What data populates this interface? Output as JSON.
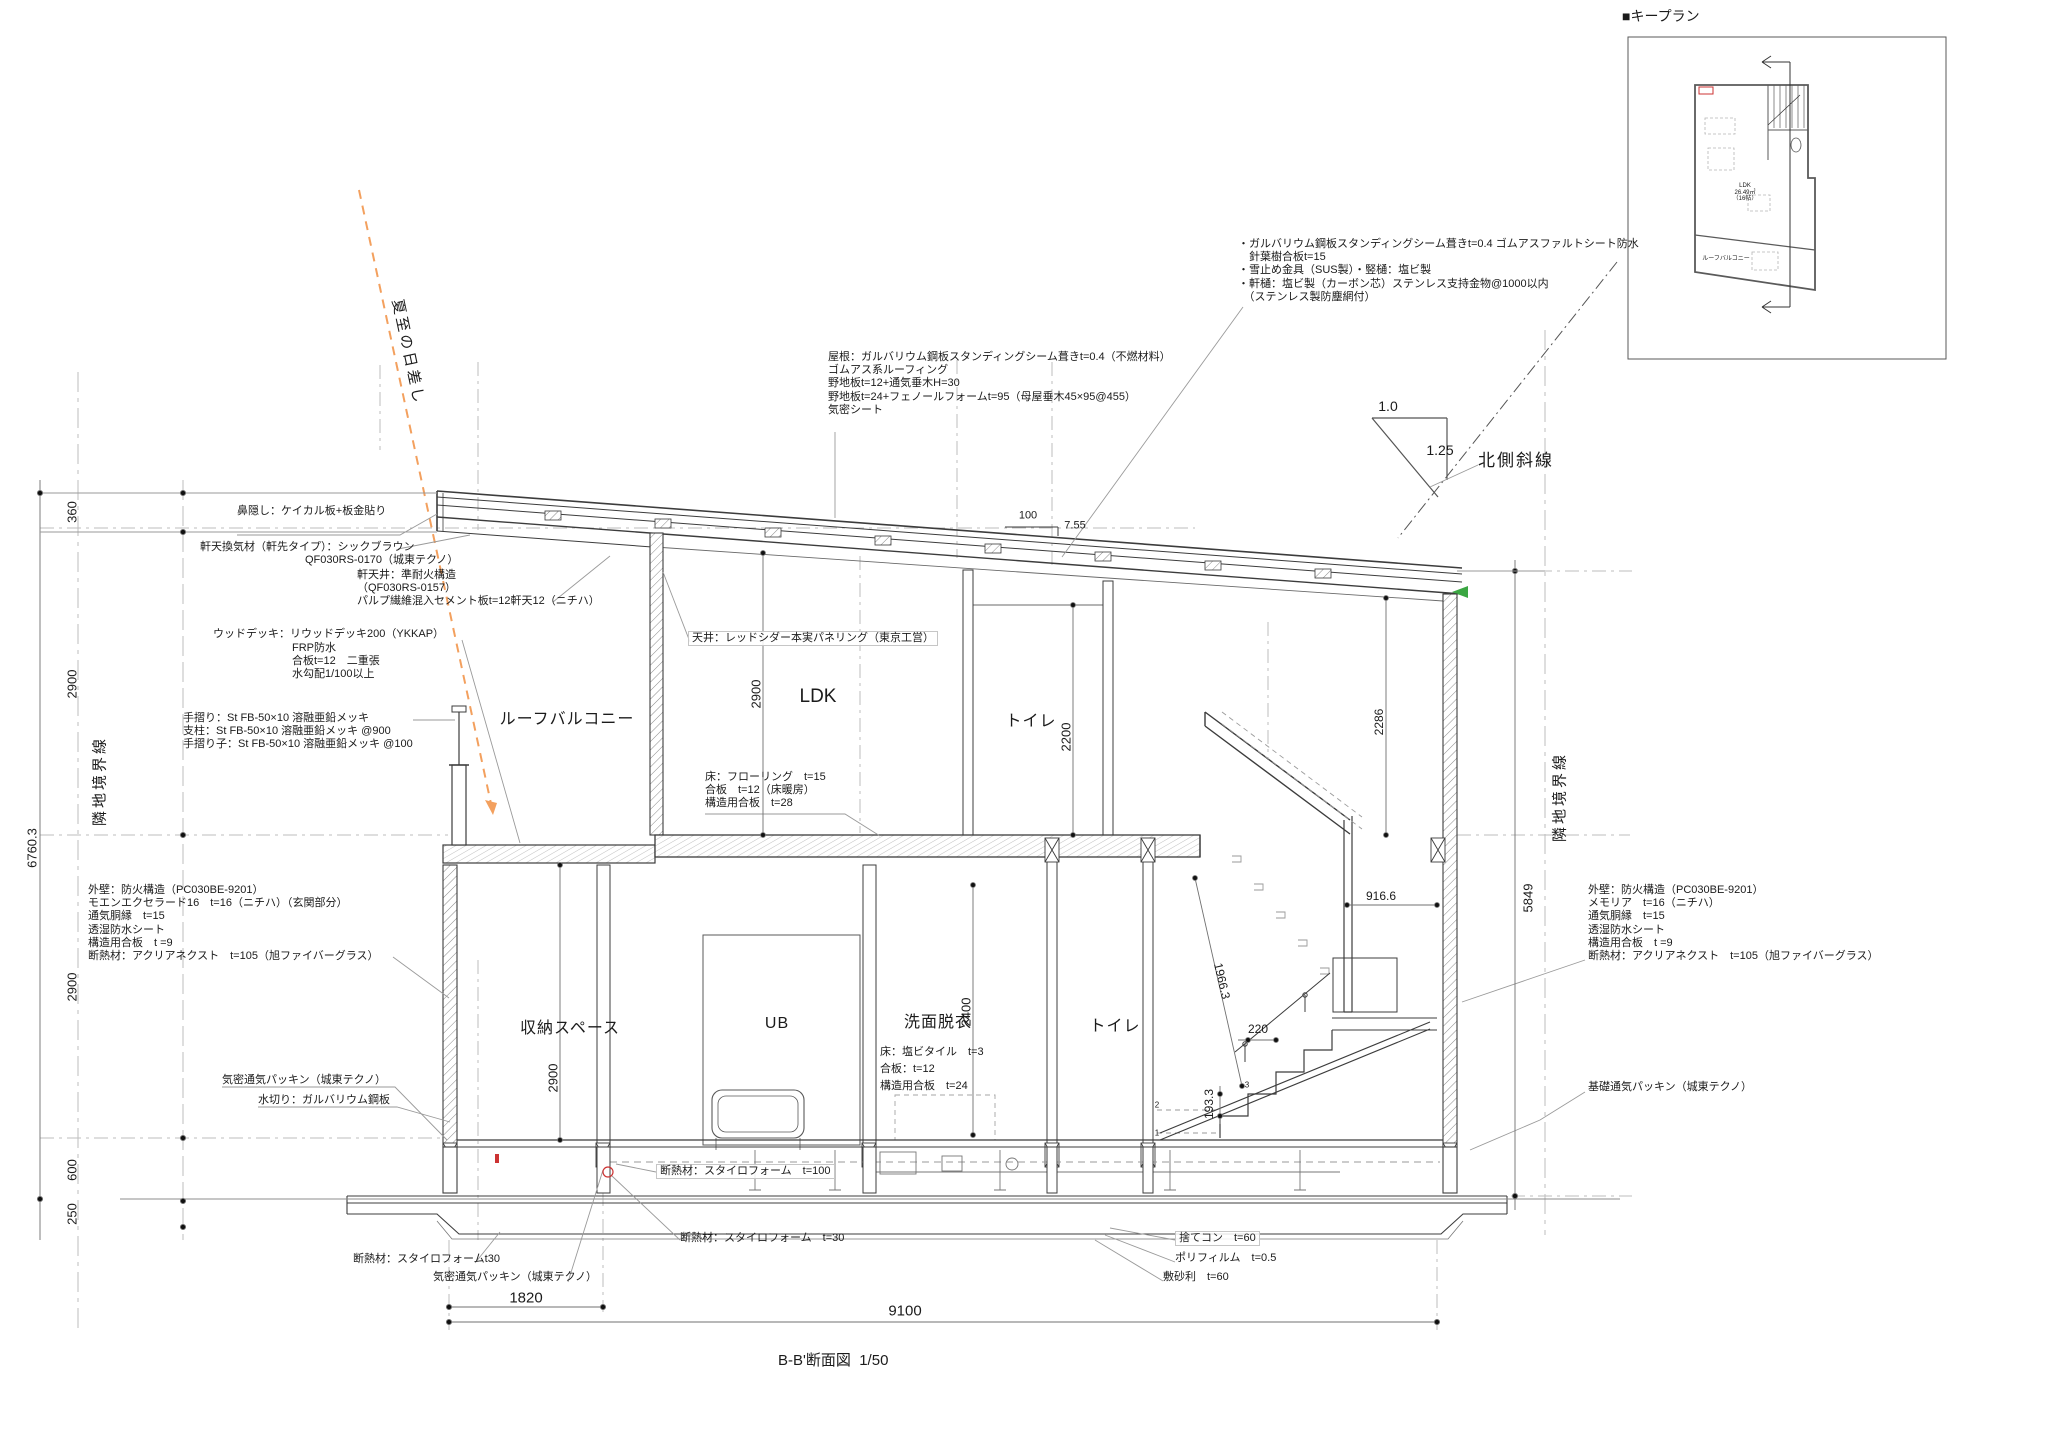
{
  "title": {
    "name": "B-B'断面図",
    "scale": "1/50"
  },
  "keyplan": {
    "title": "■キープラン",
    "ldk": [
      "LDK",
      "26.49㎡",
      "（16帖）"
    ],
    "balcony": "ルーフバルコニー"
  },
  "labels": {
    "sun": "夏至の日差し",
    "north_slope": "北側斜線",
    "slope_run": "1.0",
    "slope_rise": "1.25",
    "roof_run": "100",
    "roof_pitch": "7.55",
    "boundary_left": "隣地境界線",
    "boundary_right": "隣地境界線"
  },
  "rooms": {
    "roof_balcony": "ルーフバルコニー",
    "ldk": "LDK",
    "toilet_2f": "トイレ",
    "storage": "収納スペース",
    "ub": "UB",
    "washroom": "洗面脱衣",
    "toilet_1f": "トイレ"
  },
  "dims": {
    "fascia": "360",
    "ldk_floor": "2900",
    "left_total": "6760.3",
    "f1_height": "2900",
    "plinth": "600",
    "footing": "250",
    "ldk_ceiling": "2900",
    "toilet_ceiling": "2200",
    "right_upper": "2286",
    "storage_h": "2900",
    "washroom_h": "2400",
    "right_total": "5849",
    "stair_diag": "1966.3",
    "stair_run": "220",
    "stair_rise": "193.3",
    "landing": "916.6",
    "entrance_w": "1820",
    "total_w": "9100",
    "step_numbers": [
      "1",
      "2",
      "3"
    ]
  },
  "notes": {
    "eaves_gutter": [
      "・ガルバリウム鋼板スタンディングシーム葺きt=0.4 ゴムアスファルトシート防水",
      "　針葉樹合板t=15",
      "・雪止め金具（SUS製）・竪樋：塩ビ製",
      "・軒樋：塩ビ製（カーボン芯）ステンレス支持金物@1000以内",
      "　（ステンレス製防塵網付）"
    ],
    "roof_spec": [
      "屋根：ガルバリウム鋼板スタンディングシーム葺きt=0.4（不燃材料）",
      "ゴムアス系ルーフィング",
      "野地板t=12+通気垂木H=30",
      "野地板t=24+フェノールフォームt=95（母屋垂木45×95@455）",
      "気密シート"
    ],
    "fascia_note": "鼻隠し：ケイカル板+板金貼り",
    "eave_vent_1": "軒天換気材（軒先タイプ）：シックブラウン",
    "eave_vent_2": "QF030RS-0170（城東テクノ）",
    "eave_soffit": [
      "軒天井：準耐火構造",
      "（QF030RS-0157）",
      "パルプ繊維混入セメント板t=12軒天12（ニチハ）"
    ],
    "wood_deck_head": "ウッドデッキ：リウッドデッキ200（YKKAP）",
    "wood_deck_sub": [
      "FRP防水",
      "合板t=12　二重張",
      "水勾配1/100以上"
    ],
    "handrail": [
      "手摺り：St FB-50×10 溶融亜鉛メッキ",
      "支柱：St FB-50×10 溶融亜鉛メッキ @900",
      "手摺り子：St FB-50×10 溶融亜鉛メッキ @100"
    ],
    "ceiling": "天井：レッドシダー本実パネリング（東京工営）",
    "floor_ldk": [
      "床：フローリング　t=15",
      "合板　t=12（床暖房）",
      "構造用合板　t=28"
    ],
    "wall_left": [
      "外壁：防火構造（PC030BE-9201）",
      "モエンエクセラード16　t=16（ニチハ）（玄関部分）",
      "通気胴縁　t=15",
      "透湿防水シート",
      "構造用合板　t =9",
      "断熱材：アクリアネクスト　t=105（旭ファイバーグラス）"
    ],
    "wall_right": [
      "外壁：防火構造（PC030BE-9201）",
      "メモリア　t=16（ニチハ）",
      "通気胴縁　t=15",
      "透湿防水シート",
      "構造用合板　t =9",
      "断熱材：アクリアネクスト　t=105（旭ファイバーグラス）"
    ],
    "floor_wet": [
      "床：塩ビタイル　t=3",
      "合板：t=12",
      "構造用合板　t=24"
    ],
    "packing_upper": "気密通気パッキン（城東テクノ）",
    "flashing": "水切り：ガルバリウム鋼板",
    "insul_floor": "断熱材：スタイロフォーム　t=100",
    "insul_slab": "断熱材：スタイロフォーム　t=30",
    "insul_t30": "断熱材：スタイロフォームt30",
    "packing_lower": "気密通気パッキン（城東テクノ）",
    "lean_concrete": "捨てコン　t=60",
    "poly_film": "ポリフィルム　t=0.5",
    "gravel": "敷砂利　t=60",
    "foundation_packing": "基礎通気パッキン（城東テクノ）"
  },
  "colors": {
    "line": "#3c3c3c",
    "light_line": "#9a9a9a",
    "sun": "#f3a05e",
    "green_mark": "#3aa642",
    "red_mark": "#cc3333"
  }
}
